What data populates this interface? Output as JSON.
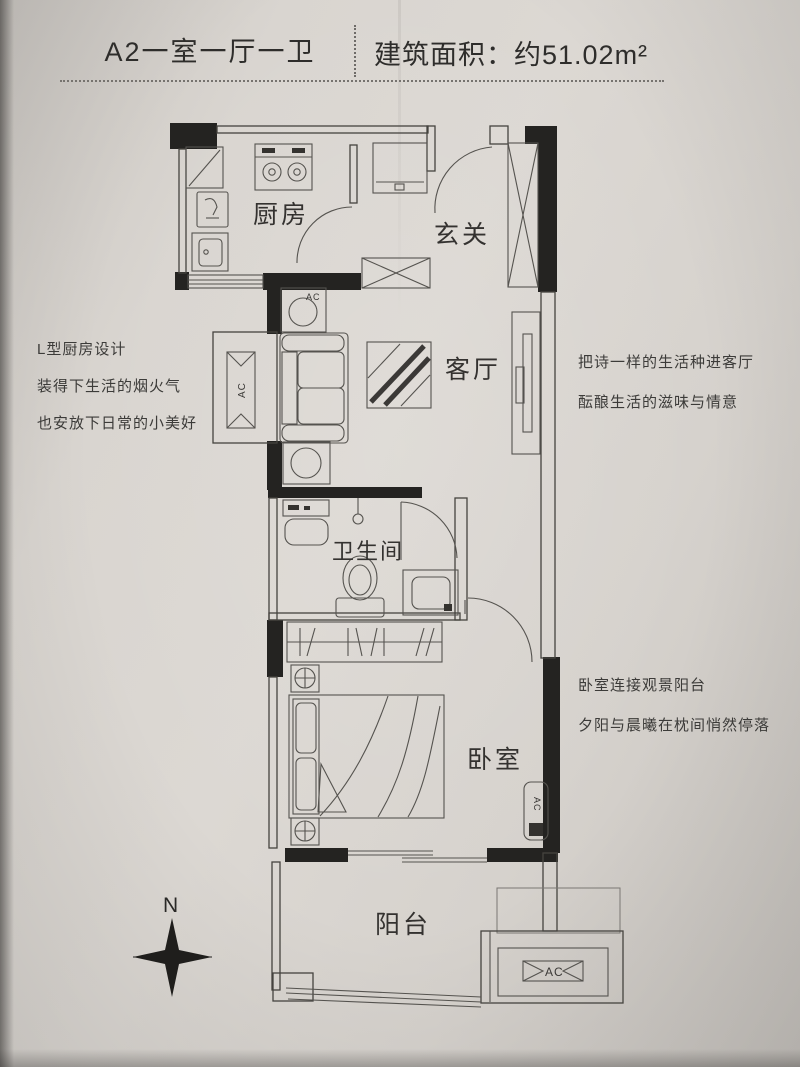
{
  "header": {
    "unit_title": "A2一室一厅一卫",
    "area_label": "建筑面积：约51.02m²"
  },
  "rooms": {
    "kitchen": "厨房",
    "entry": "玄关",
    "living": "客厅",
    "bathroom": "卫生间",
    "bedroom": "卧室",
    "balcony": "阳台"
  },
  "annotations": {
    "kitchen": [
      "L型厨房设计",
      "装得下生活的烟火气",
      "也安放下日常的小美好"
    ],
    "living": [
      "把诗一样的生活种进客厅",
      "酝酿生活的滋味与情意"
    ],
    "bedroom": [
      "卧室连接观景阳台",
      "夕阳与晨曦在枕间悄然停落"
    ]
  },
  "labels": {
    "ac": "AC",
    "north": "N"
  },
  "colors": {
    "paper": "#d6d2cd",
    "wall_ink": "#242321",
    "line_ink": "#55534f",
    "text_ink": "#3c3b39"
  }
}
